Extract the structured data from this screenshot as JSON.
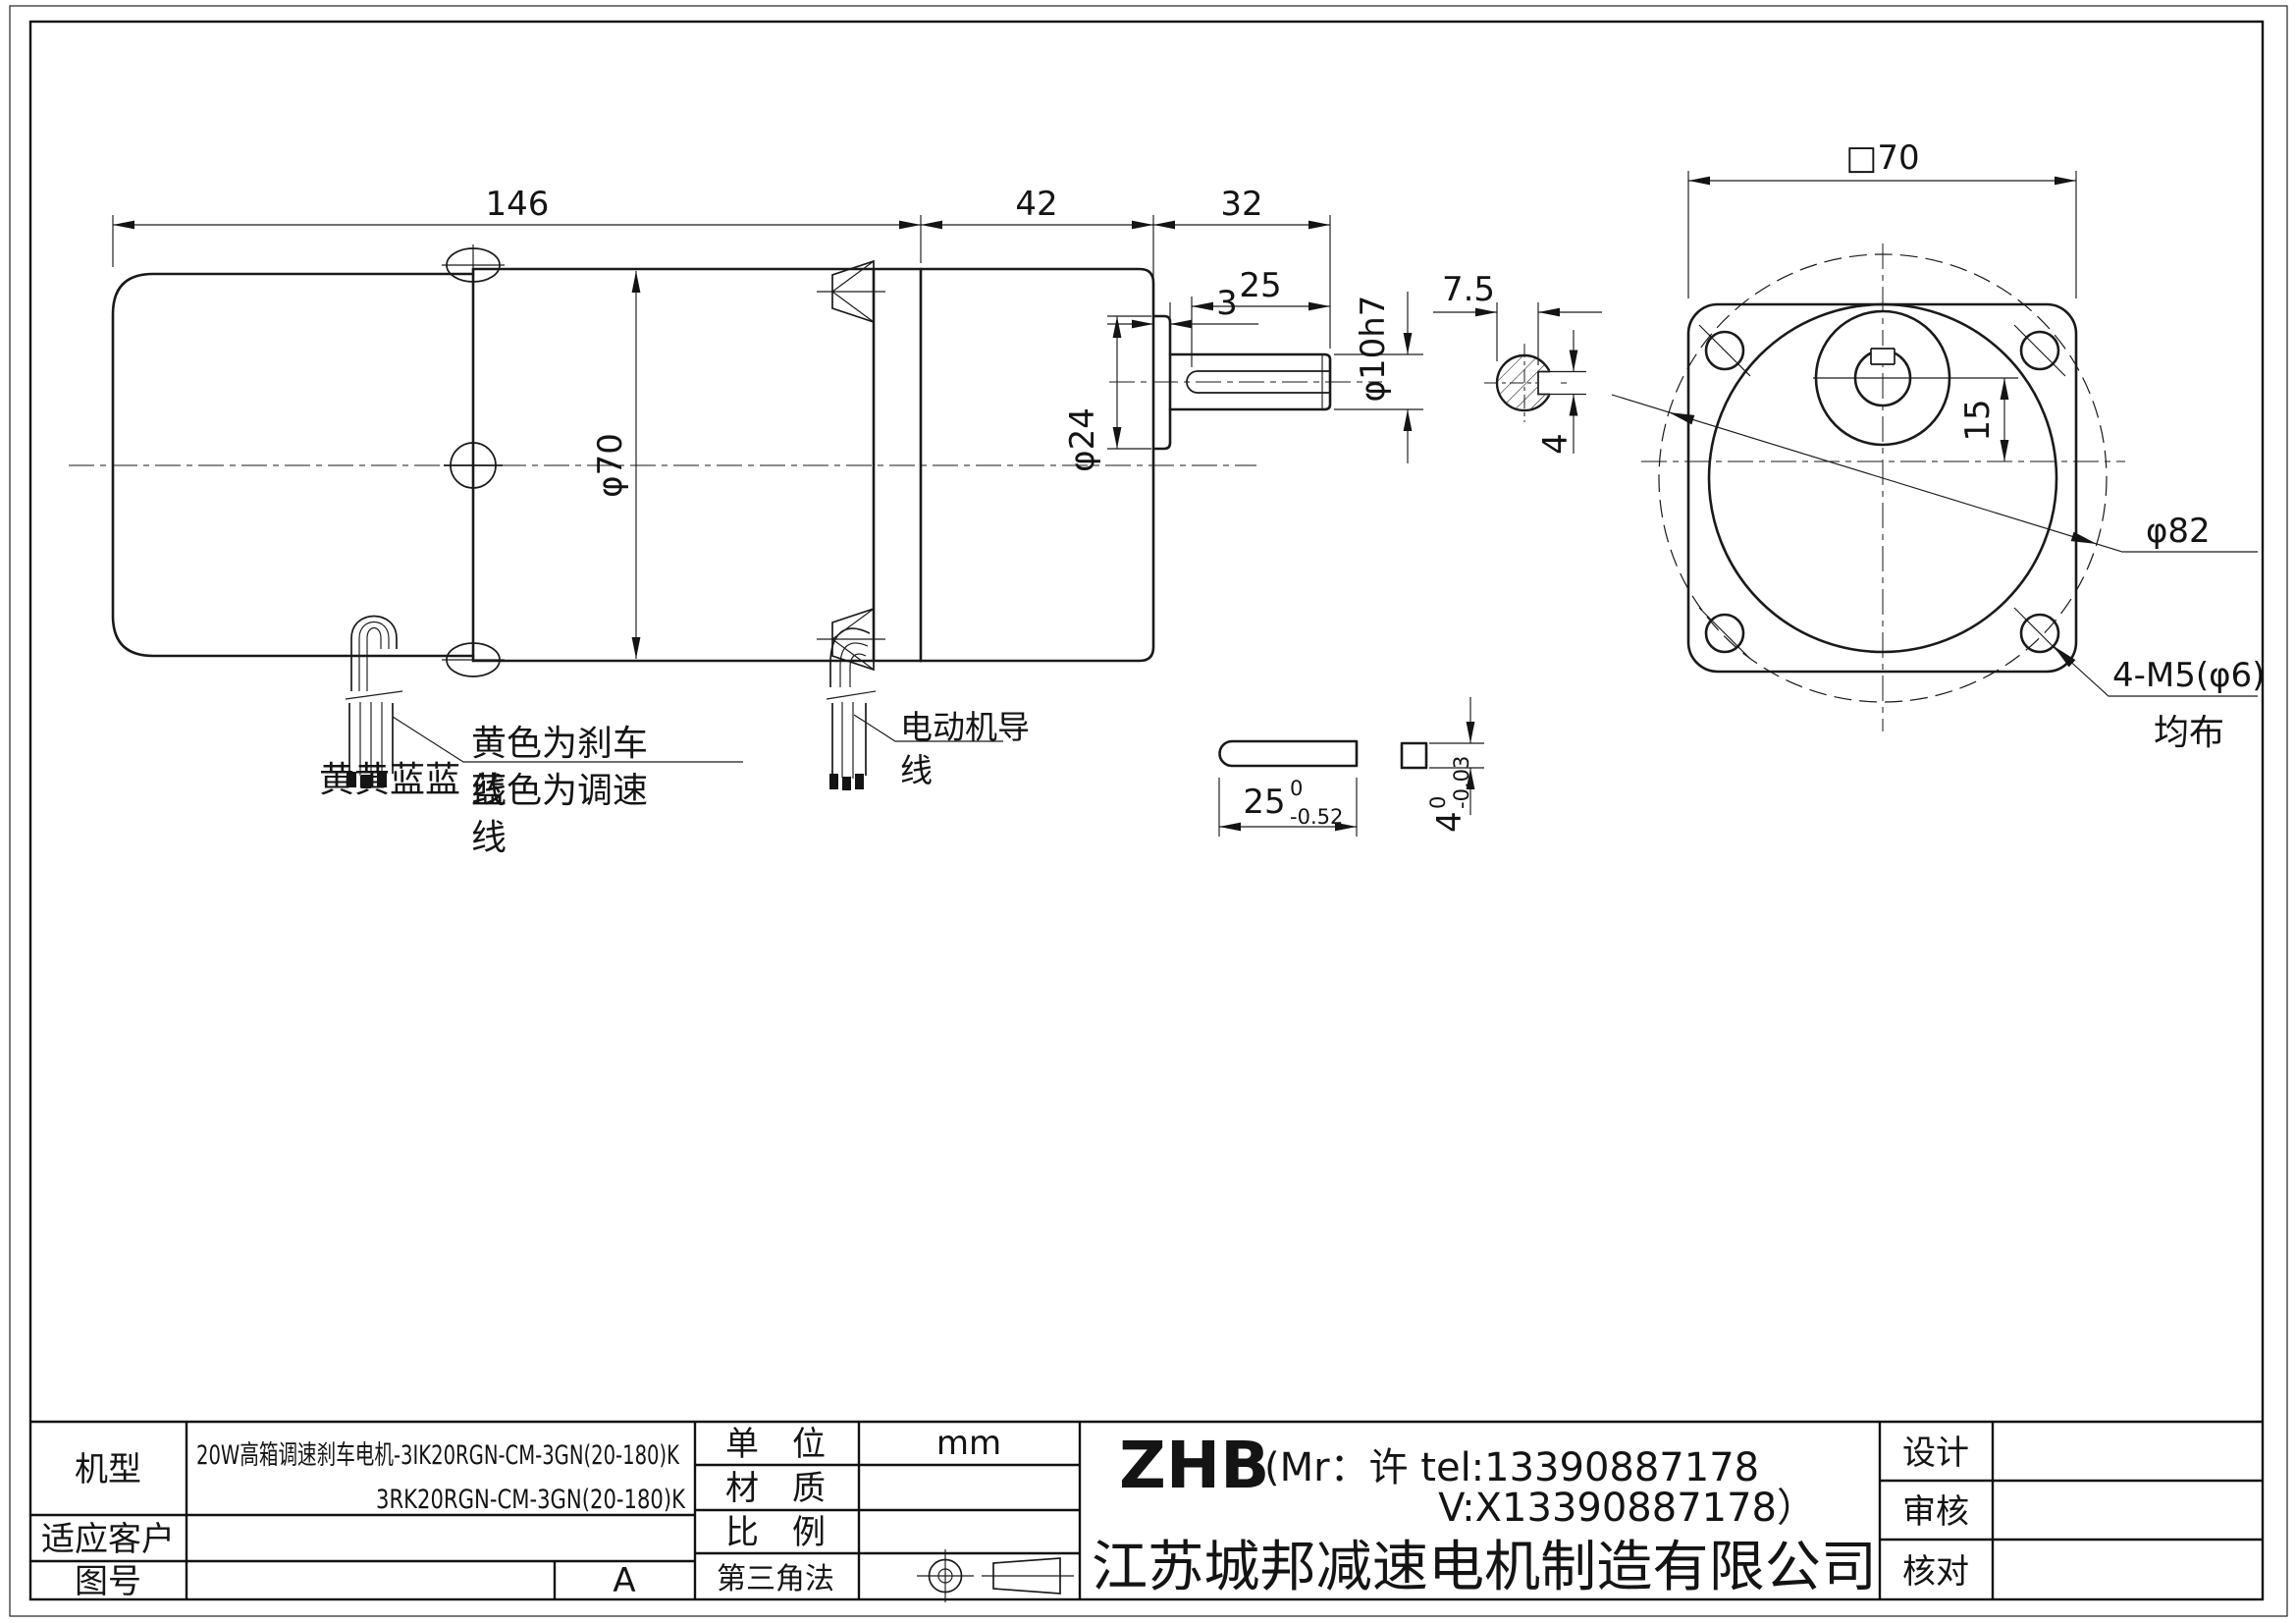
{
  "drawing": {
    "dims": {
      "length_total": "146",
      "length_gearbox": "42",
      "length_shaft": "32",
      "boss_offset": "3",
      "shaft_key_len": "25",
      "boss_dia": "φ24",
      "body_dia": "φ70",
      "shaft_dia": "φ10h7",
      "key_flat": "7.5",
      "key_width": "4",
      "flange_square": "□70",
      "shaft_offset": "15",
      "bolt_circle": "φ82",
      "mount_holes": "4-M5(φ6)",
      "mount_holes_note": "均布"
    },
    "key_detail": {
      "length": "25",
      "length_tol_upper": "0",
      "length_tol_lower": "-0.52",
      "height": "4",
      "height_tol_upper": "0",
      "height_tol_lower": "-0.03"
    },
    "annotations": {
      "wire_colors": "黄黄蓝蓝",
      "brake_wire_l1": "黄色为刹车",
      "brake_wire_l2": "线",
      "speed_wire_l1": "蓝色为调速",
      "speed_wire_l2": "线",
      "motor_wire_l1": "电动机导",
      "motor_wire_l2": "线"
    }
  },
  "title_block": {
    "model_label": "机型",
    "model_line1": "20W高箱调速刹车电机-3IK20RGN-CM-3GN(20-180)K",
    "model_line2": "3RK20RGN-CM-3GN(20-180)K",
    "customer_label": "适应客户",
    "customer_value": "",
    "drawing_no_label": "图号",
    "drawing_no_value": "",
    "revision": "A",
    "unit_label": "单　位",
    "unit_value": "mm",
    "material_label": "材　质",
    "material_value": "",
    "scale_label": "比　例",
    "scale_value": "",
    "projection_label": "第三角法",
    "brand": "ZHB",
    "contact_line1": "(Mr：许 tel:13390887178",
    "contact_line2": "V:X13390887178）",
    "company": "江苏城邦减速电机制造有限公司",
    "design_label": "设计",
    "design_value": "",
    "review_label": "审核",
    "review_value": "",
    "check_label": "核对",
    "check_value": ""
  }
}
